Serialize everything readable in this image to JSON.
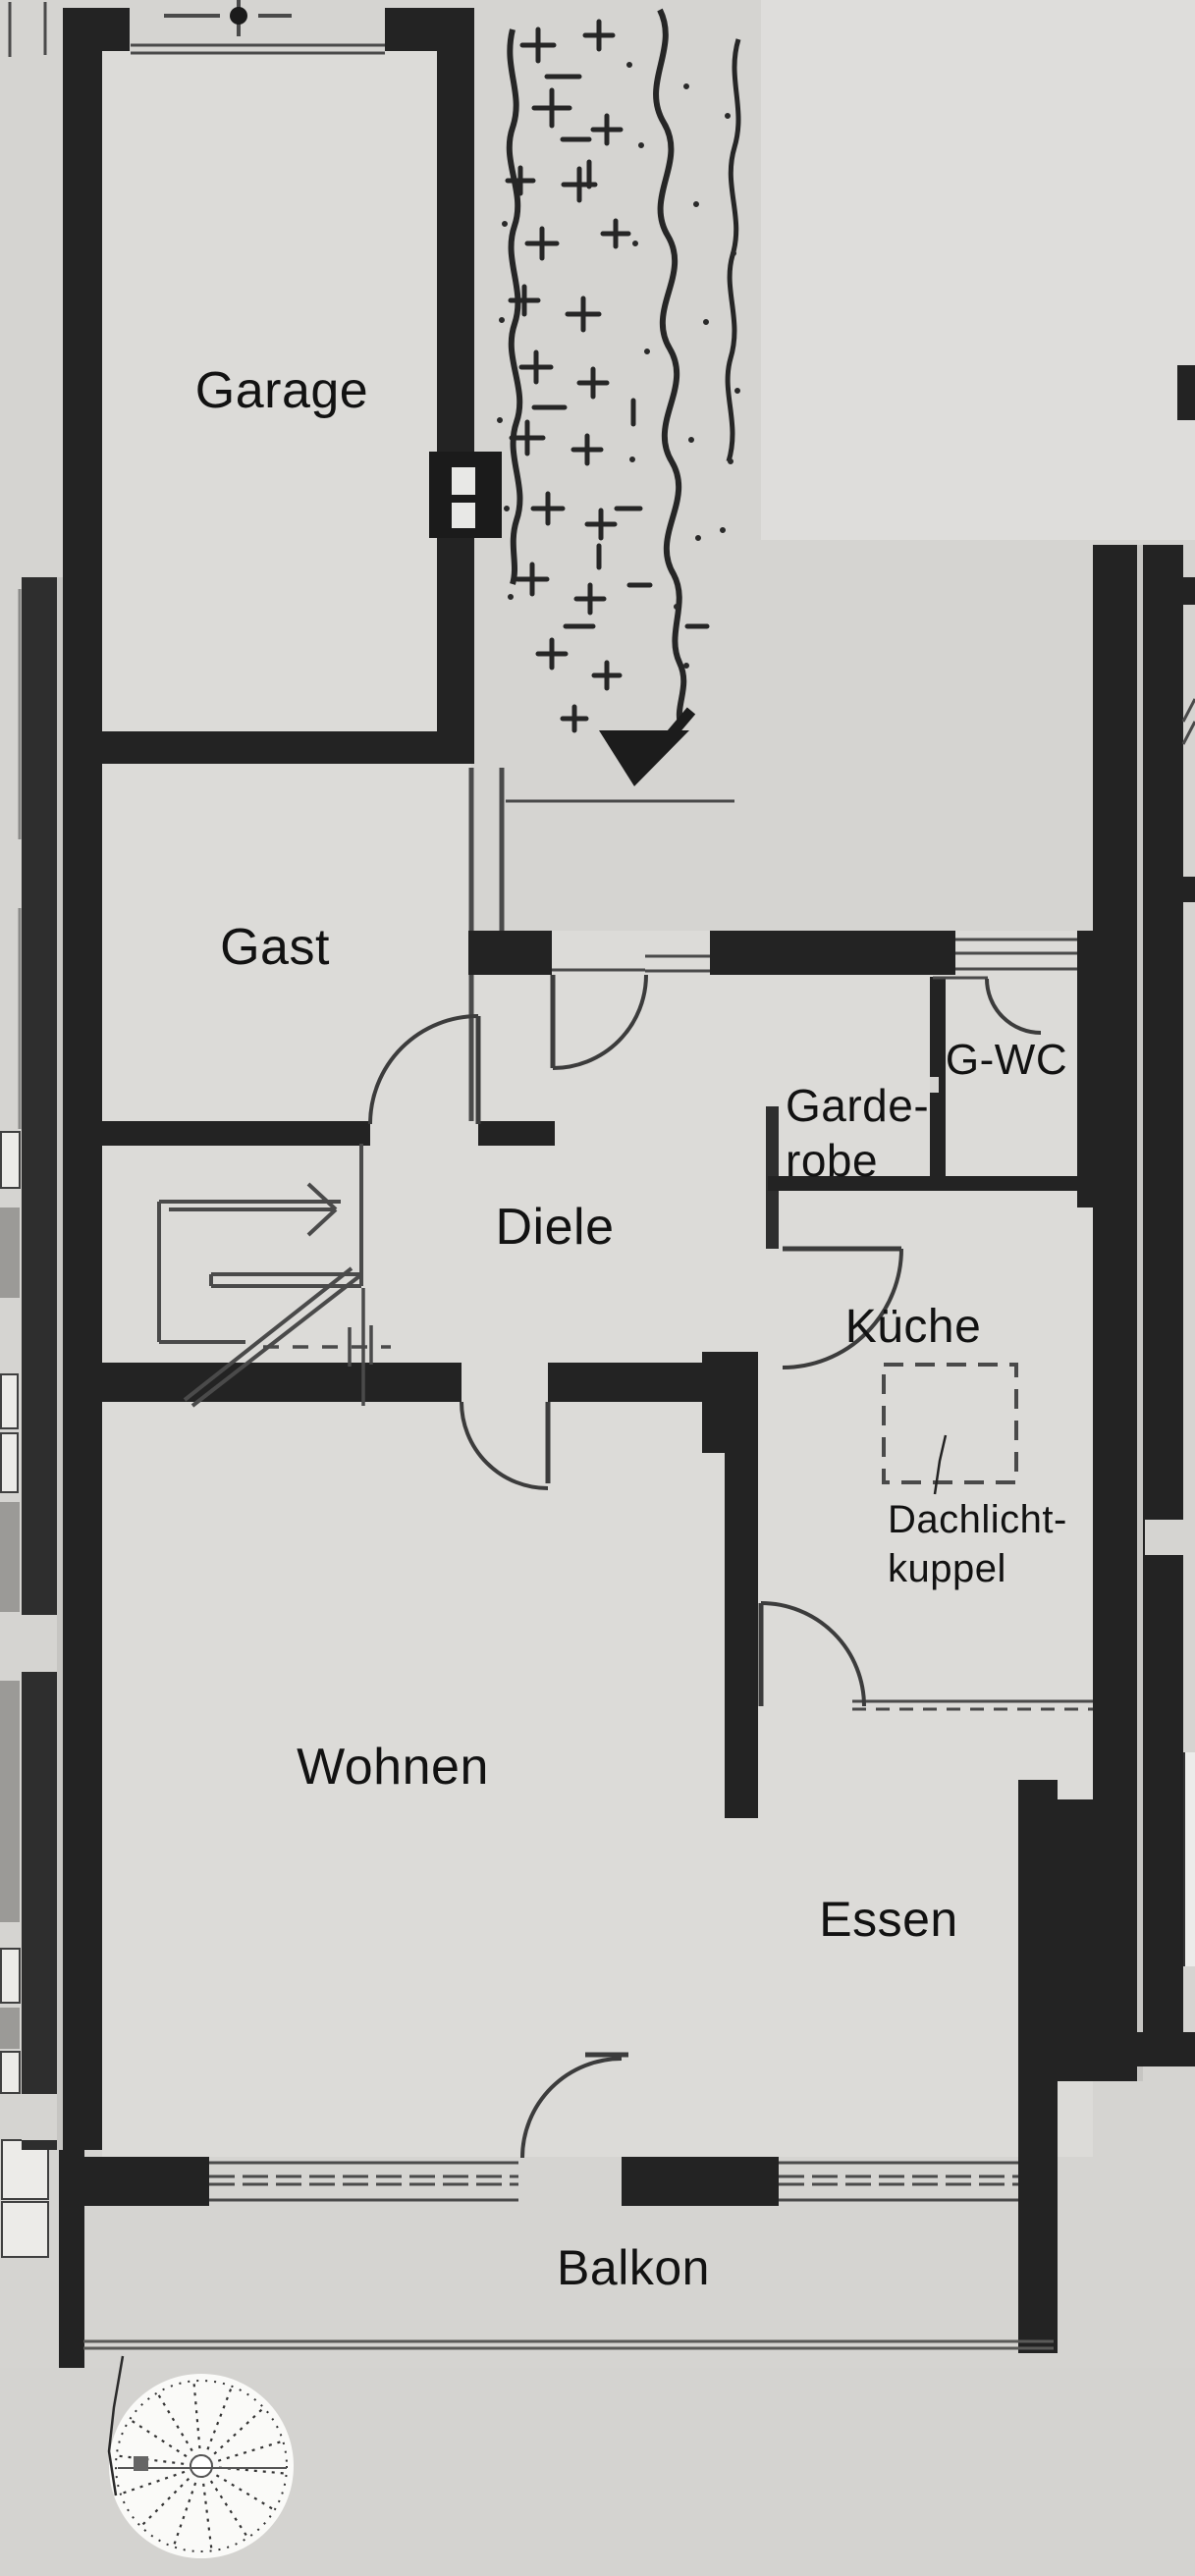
{
  "floorplan": {
    "room_labels": {
      "garage": "Garage",
      "gast": "Gast",
      "diele": "Diele",
      "garderobe_line1": "Garde-",
      "garderobe_line2": "robe",
      "gwc": "G-WC",
      "kueche": "Küche",
      "wohnen": "Wohnen",
      "essen": "Essen",
      "balkon": "Balkon"
    },
    "annotation_labels": {
      "dachlichtkuppel_line1": "Dachlicht-",
      "dachlichtkuppel_line2": "kuppel"
    },
    "colors": {
      "paper": "#d5d4d1",
      "paper_light": "#dedddb",
      "interior": "#dcdbd8",
      "wall": "#232323",
      "thin_line": "#4a4a4a",
      "text": "#121212"
    }
  }
}
